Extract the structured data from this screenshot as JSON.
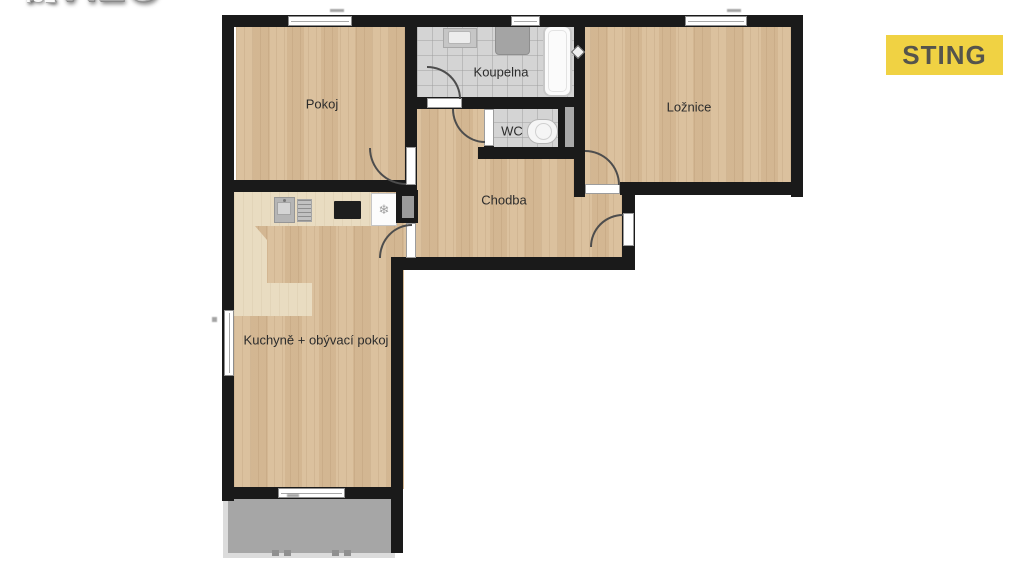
{
  "branding": {
    "logo_main": "AVÍZO",
    "logo_suffix": ".cz",
    "agency_badge": "STING"
  },
  "floorplan": {
    "rooms": {
      "pokoj": {
        "label": "Pokoj"
      },
      "koupelna": {
        "label": "Koupelna"
      },
      "wc": {
        "label": "WC"
      },
      "loznice": {
        "label": "Ložnice"
      },
      "chodba": {
        "label": "Chodba"
      },
      "kuchyne": {
        "label": "Kuchyně + obývací pokoj"
      }
    },
    "icons": {
      "fridge_glyph": "❄"
    },
    "colors": {
      "wall": "#1a1a1a",
      "wood": "#d9bd98",
      "counter": "#e9dcc1",
      "tile": "#d4d4d4",
      "balcony": "#a6a6a6",
      "badge_bg": "#f0d243",
      "badge_text": "#55544c"
    }
  }
}
